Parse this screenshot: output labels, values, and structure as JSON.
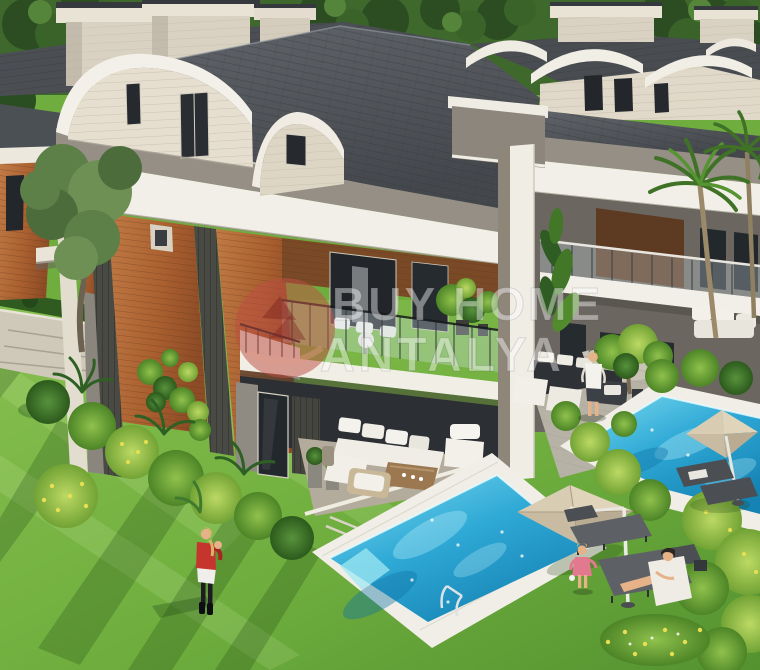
{
  "watermark": {
    "line1": "BUY HOME",
    "line2": "ANTALYA",
    "logo_color": "#bd4f44",
    "text_color": "#ffffff"
  },
  "scene": {
    "description": "Aerial 3D render of modern twin villas with curved barrel roofs, wooden facade panels, balconies, two private swimming pools, sun loungers, parasols, lawns and tropical landscaping",
    "figures": [
      "woman-with-child-on-lawn",
      "man-standing-on-patio",
      "toddler-near-pool",
      "woman-on-sun-lounger"
    ],
    "features": [
      "arched-dormer-roofs",
      "chimneys",
      "glass-balconies",
      "two-pools",
      "pool-ladder",
      "two-parasols",
      "sun-loungers",
      "palm-trees",
      "garden-bushes"
    ]
  },
  "palette": {
    "roofDark": "#54585d",
    "roofEdge": "#3e4247",
    "cream": "#f2efe8",
    "creamShade": "#e3dccd",
    "taupe": "#968f85",
    "wood": "#b06a38",
    "woodDark": "#6e4223",
    "slatDark": "#4a4a44",
    "wallGray": "#8f8b83",
    "glassDark": "#272b2f",
    "deck": "#f0eee6",
    "pool": "#2fb4dc",
    "poolDeep": "#1287b8",
    "poolLight": "#86e0f0",
    "lawn": "#6fae3e",
    "lawnLight": "#8fc456",
    "lawnShadow": "#3c7022",
    "bushDark": "#2c5a1c",
    "bushMid": "#4d8527",
    "bushLight": "#9cc553",
    "umbrella": "#cbbda1",
    "lounger": "#5a5e62",
    "skin": "#e6b287",
    "accentRed": "#c6342e",
    "white": "#f4f2ec"
  }
}
